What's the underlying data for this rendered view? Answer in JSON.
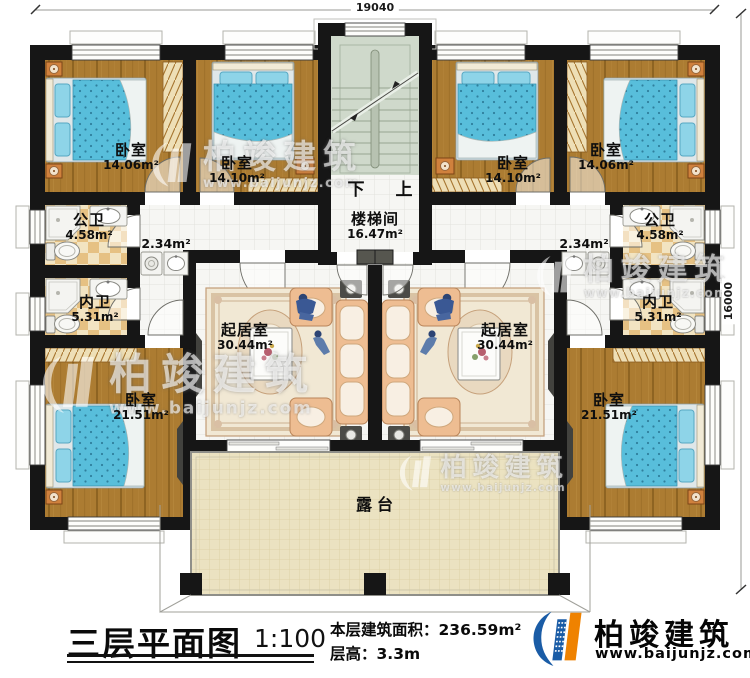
{
  "dimensions": {
    "top": "19040",
    "right": "16000"
  },
  "stairwell": {
    "name": "楼梯间",
    "area": "16.47m²",
    "down_label": "下",
    "up_label": "上"
  },
  "terrace_label": "露台",
  "closets": {
    "left": "2.34m²",
    "right": "2.34m²"
  },
  "rooms": [
    {
      "id": "bedroom-top-far-left",
      "name": "卧室",
      "area": "14.06m²"
    },
    {
      "id": "bedroom-top-mid-left",
      "name": "卧室",
      "area": "14.10m²"
    },
    {
      "id": "bath-public-left",
      "name": "公卫",
      "area": "4.58m²"
    },
    {
      "id": "bath-inner-left",
      "name": "内卫",
      "area": "5.31m²"
    },
    {
      "id": "living-left",
      "name": "起居室",
      "area": "30.44m²"
    },
    {
      "id": "bedroom-bottom-left",
      "name": "卧室",
      "area": "21.51m²"
    },
    {
      "id": "bedroom-top-mid-right",
      "name": "卧室",
      "area": "14.10m²"
    },
    {
      "id": "bedroom-top-far-right",
      "name": "卧室",
      "area": "14.06m²"
    },
    {
      "id": "bath-public-right",
      "name": "公卫",
      "area": "4.58m²"
    },
    {
      "id": "bath-inner-right",
      "name": "内卫",
      "area": "5.31m²"
    },
    {
      "id": "living-right",
      "name": "起居室",
      "area": "30.44m²"
    },
    {
      "id": "bedroom-bottom-right",
      "name": "卧室",
      "area": "21.51m²"
    }
  ],
  "footer": {
    "title": "三层平面图",
    "scale": "1:100",
    "area_label": "本层建筑面积：",
    "area_value": "236.59m²",
    "height_label": "层高：",
    "height_value": "3.3m"
  },
  "brand": {
    "name": "柏竣建筑",
    "website": "www.baijunjz.com"
  },
  "colors": {
    "wall": "#161616",
    "wood_floor": "#ac7c32",
    "bath_tile": "#e6c183",
    "bed": "#58bedb",
    "terrace": "#ebe2c1",
    "stairs": "#cfd9cb",
    "brand_blue": "#1a5ca6",
    "brand_orange": "#ef8200"
  }
}
